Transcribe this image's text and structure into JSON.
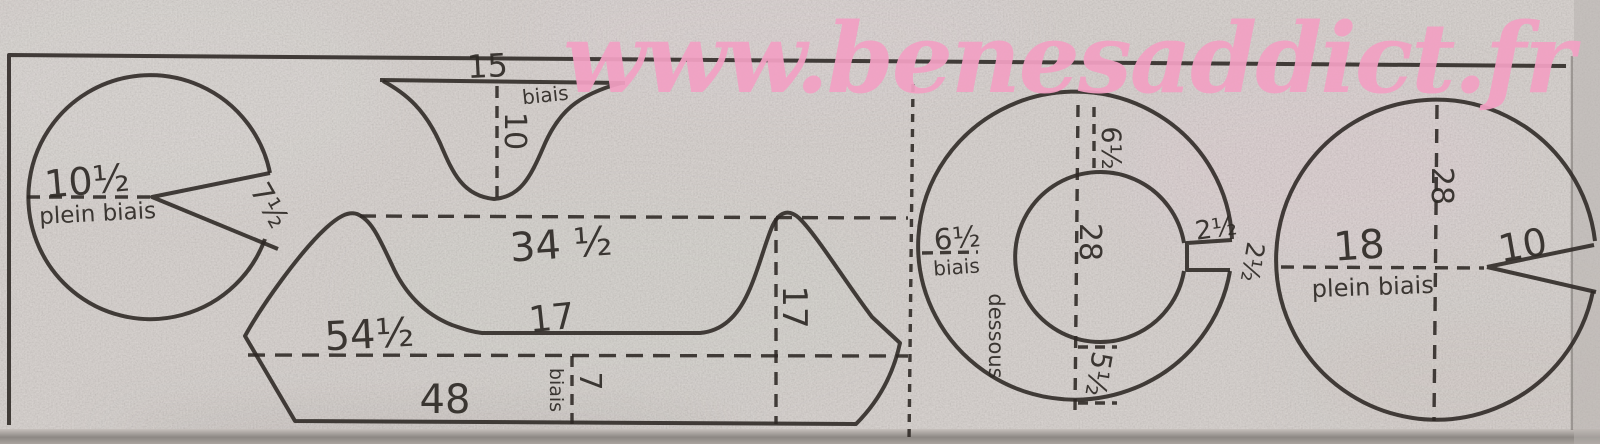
{
  "watermark": {
    "text": "www.benesaddict.fr",
    "color": "#f2a0c3"
  },
  "colors": {
    "paper": "#d5cfcb",
    "ink": "#2c2723",
    "bottom_shadow": "#8d8884"
  },
  "pieces": {
    "pie": {
      "radius_dim": "10½",
      "grain": "plein biais",
      "notch_dim": "7½"
    },
    "funnel": {
      "width_dim": "15",
      "grain": "biais",
      "depth_dim": "10"
    },
    "band": {
      "upper_width_dim": "34 ½",
      "valley_dim": "17",
      "fold_width_dim": "54½",
      "bottom_width_dim": "48",
      "side_height_dim": "17",
      "hem_grain": "biais",
      "hem_depth_dim": "7"
    },
    "ring": {
      "top_band_dim": "6½",
      "left_band_dim": "6½",
      "left_grain": "biais",
      "inner_diameter_dim": "28",
      "notch_top_dim": "2½",
      "notch_side_dim": "2½",
      "bottom_band_dim": "5½",
      "underside_label": "dessous"
    },
    "disc": {
      "vertical_dim": "28",
      "left_radius_dim": "18",
      "right_radius_dim": "10",
      "grain": "plein biais"
    }
  }
}
